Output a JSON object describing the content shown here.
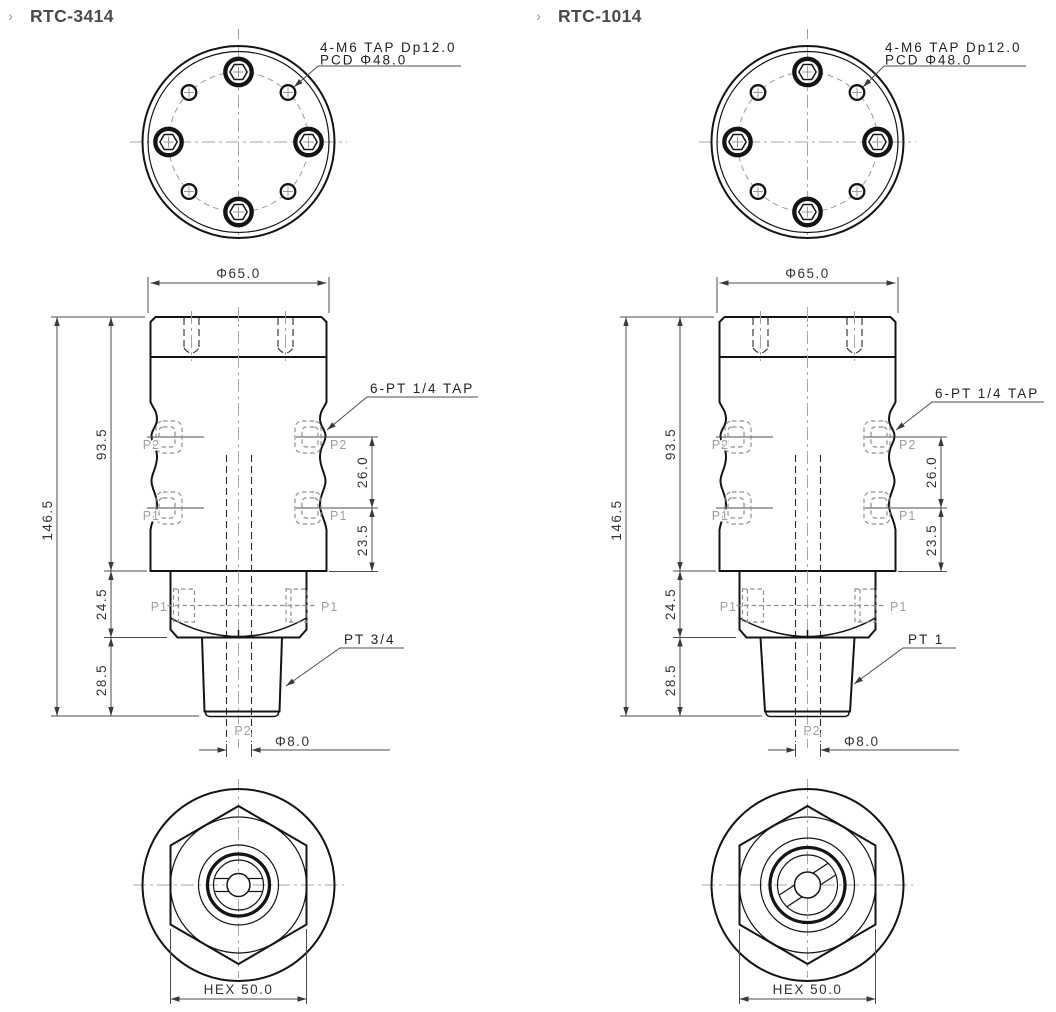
{
  "page": {
    "background": "#ffffff"
  },
  "colors": {
    "outline": "#141414",
    "dimension": "#4d4d4d",
    "muted": "#9b9b9b",
    "title": "#4a4a4a"
  },
  "drawings": [
    {
      "bullet": "›",
      "title": "RTC-3414",
      "top_view": {
        "callout_line1": "4-M6 TAP Dp12.0",
        "callout_line2": "PCD Φ48.0"
      },
      "front_view": {
        "outer_dia": "Φ65.0",
        "total_h": "146.5",
        "body_h": "93.5",
        "hex_h": "24.5",
        "stem_h": "28.5",
        "port_pitch": "26.0",
        "port_offset": "23.5",
        "ports_callout": "6-PT 1/4 TAP",
        "thread_callout": "PT 3/4",
        "bore_dia": "Φ8.0",
        "port1": "P1",
        "port2": "P2"
      },
      "bottom_view": {
        "hex_dim": "HEX 50.0"
      }
    },
    {
      "bullet": "›",
      "title": "RTC-1014",
      "top_view": {
        "callout_line1": "4-M6 TAP Dp12.0",
        "callout_line2": "PCD Φ48.0"
      },
      "front_view": {
        "outer_dia": "Φ65.0",
        "total_h": "146.5",
        "body_h": "93.5",
        "hex_h": "24.5",
        "stem_h": "28.5",
        "port_pitch": "26.0",
        "port_offset": "23.5",
        "ports_callout": "6-PT 1/4 TAP",
        "thread_callout": "PT 1",
        "bore_dia": "Φ8.0",
        "port1": "P1",
        "port2": "P2"
      },
      "bottom_view": {
        "hex_dim": "HEX 50.0"
      }
    }
  ]
}
